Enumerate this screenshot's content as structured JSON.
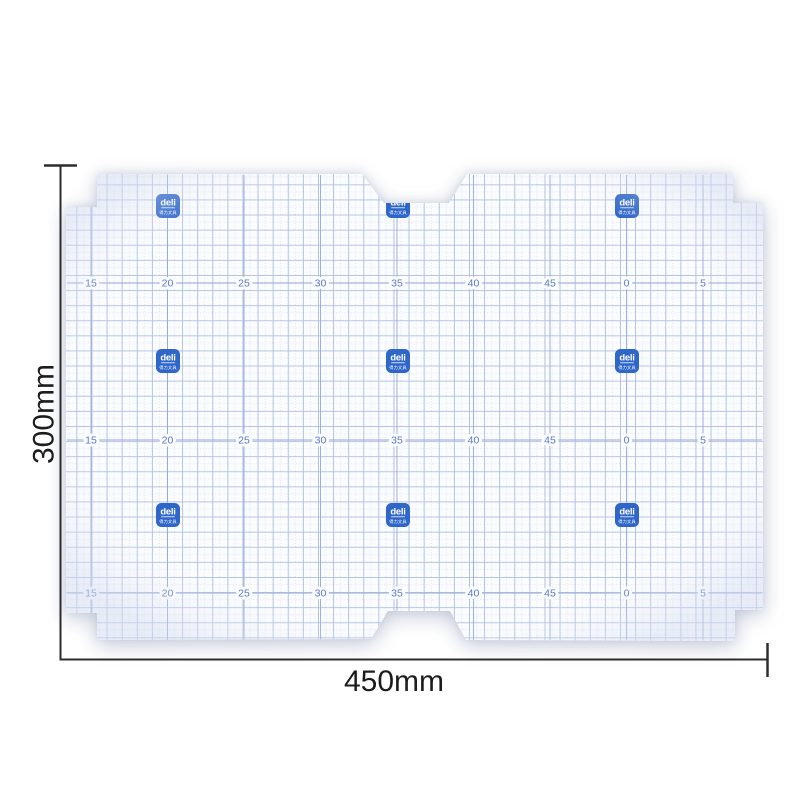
{
  "canvas": {
    "width": 800,
    "height": 801,
    "background": "#ffffff"
  },
  "dimensions": {
    "height_label": "300mm",
    "width_label": "450mm",
    "line_color": "#2d2d2d",
    "label_color": "#1c1c1c"
  },
  "sheet": {
    "description": "transparent self-adhesive book cover sheet with centimeter grid",
    "fill": "#fbfcfe",
    "grid": {
      "minor_color": "#d9dff0",
      "major_color": "#aebde2",
      "accent_color": "#93a7d8"
    },
    "ruler": {
      "number_color": "#5b79c6",
      "row_y": [
        283,
        440,
        593
      ],
      "columns": [
        {
          "label": "15",
          "x": 91
        },
        {
          "label": "20",
          "x": 167.5
        },
        {
          "label": "25",
          "x": 244
        },
        {
          "label": "30",
          "x": 320.5
        },
        {
          "label": "35",
          "x": 397
        },
        {
          "label": "40",
          "x": 473.5
        },
        {
          "label": "45",
          "x": 550
        },
        {
          "label": "0",
          "x": 626.5
        },
        {
          "label": "5",
          "x": 703
        }
      ]
    },
    "brand": {
      "name": "deli",
      "subtext": "得力文具",
      "badge_color": "#2f66c9",
      "text_color": "#ffffff",
      "cols_x": [
        168,
        398,
        627
      ],
      "rows_y": [
        206,
        361,
        515
      ]
    }
  }
}
